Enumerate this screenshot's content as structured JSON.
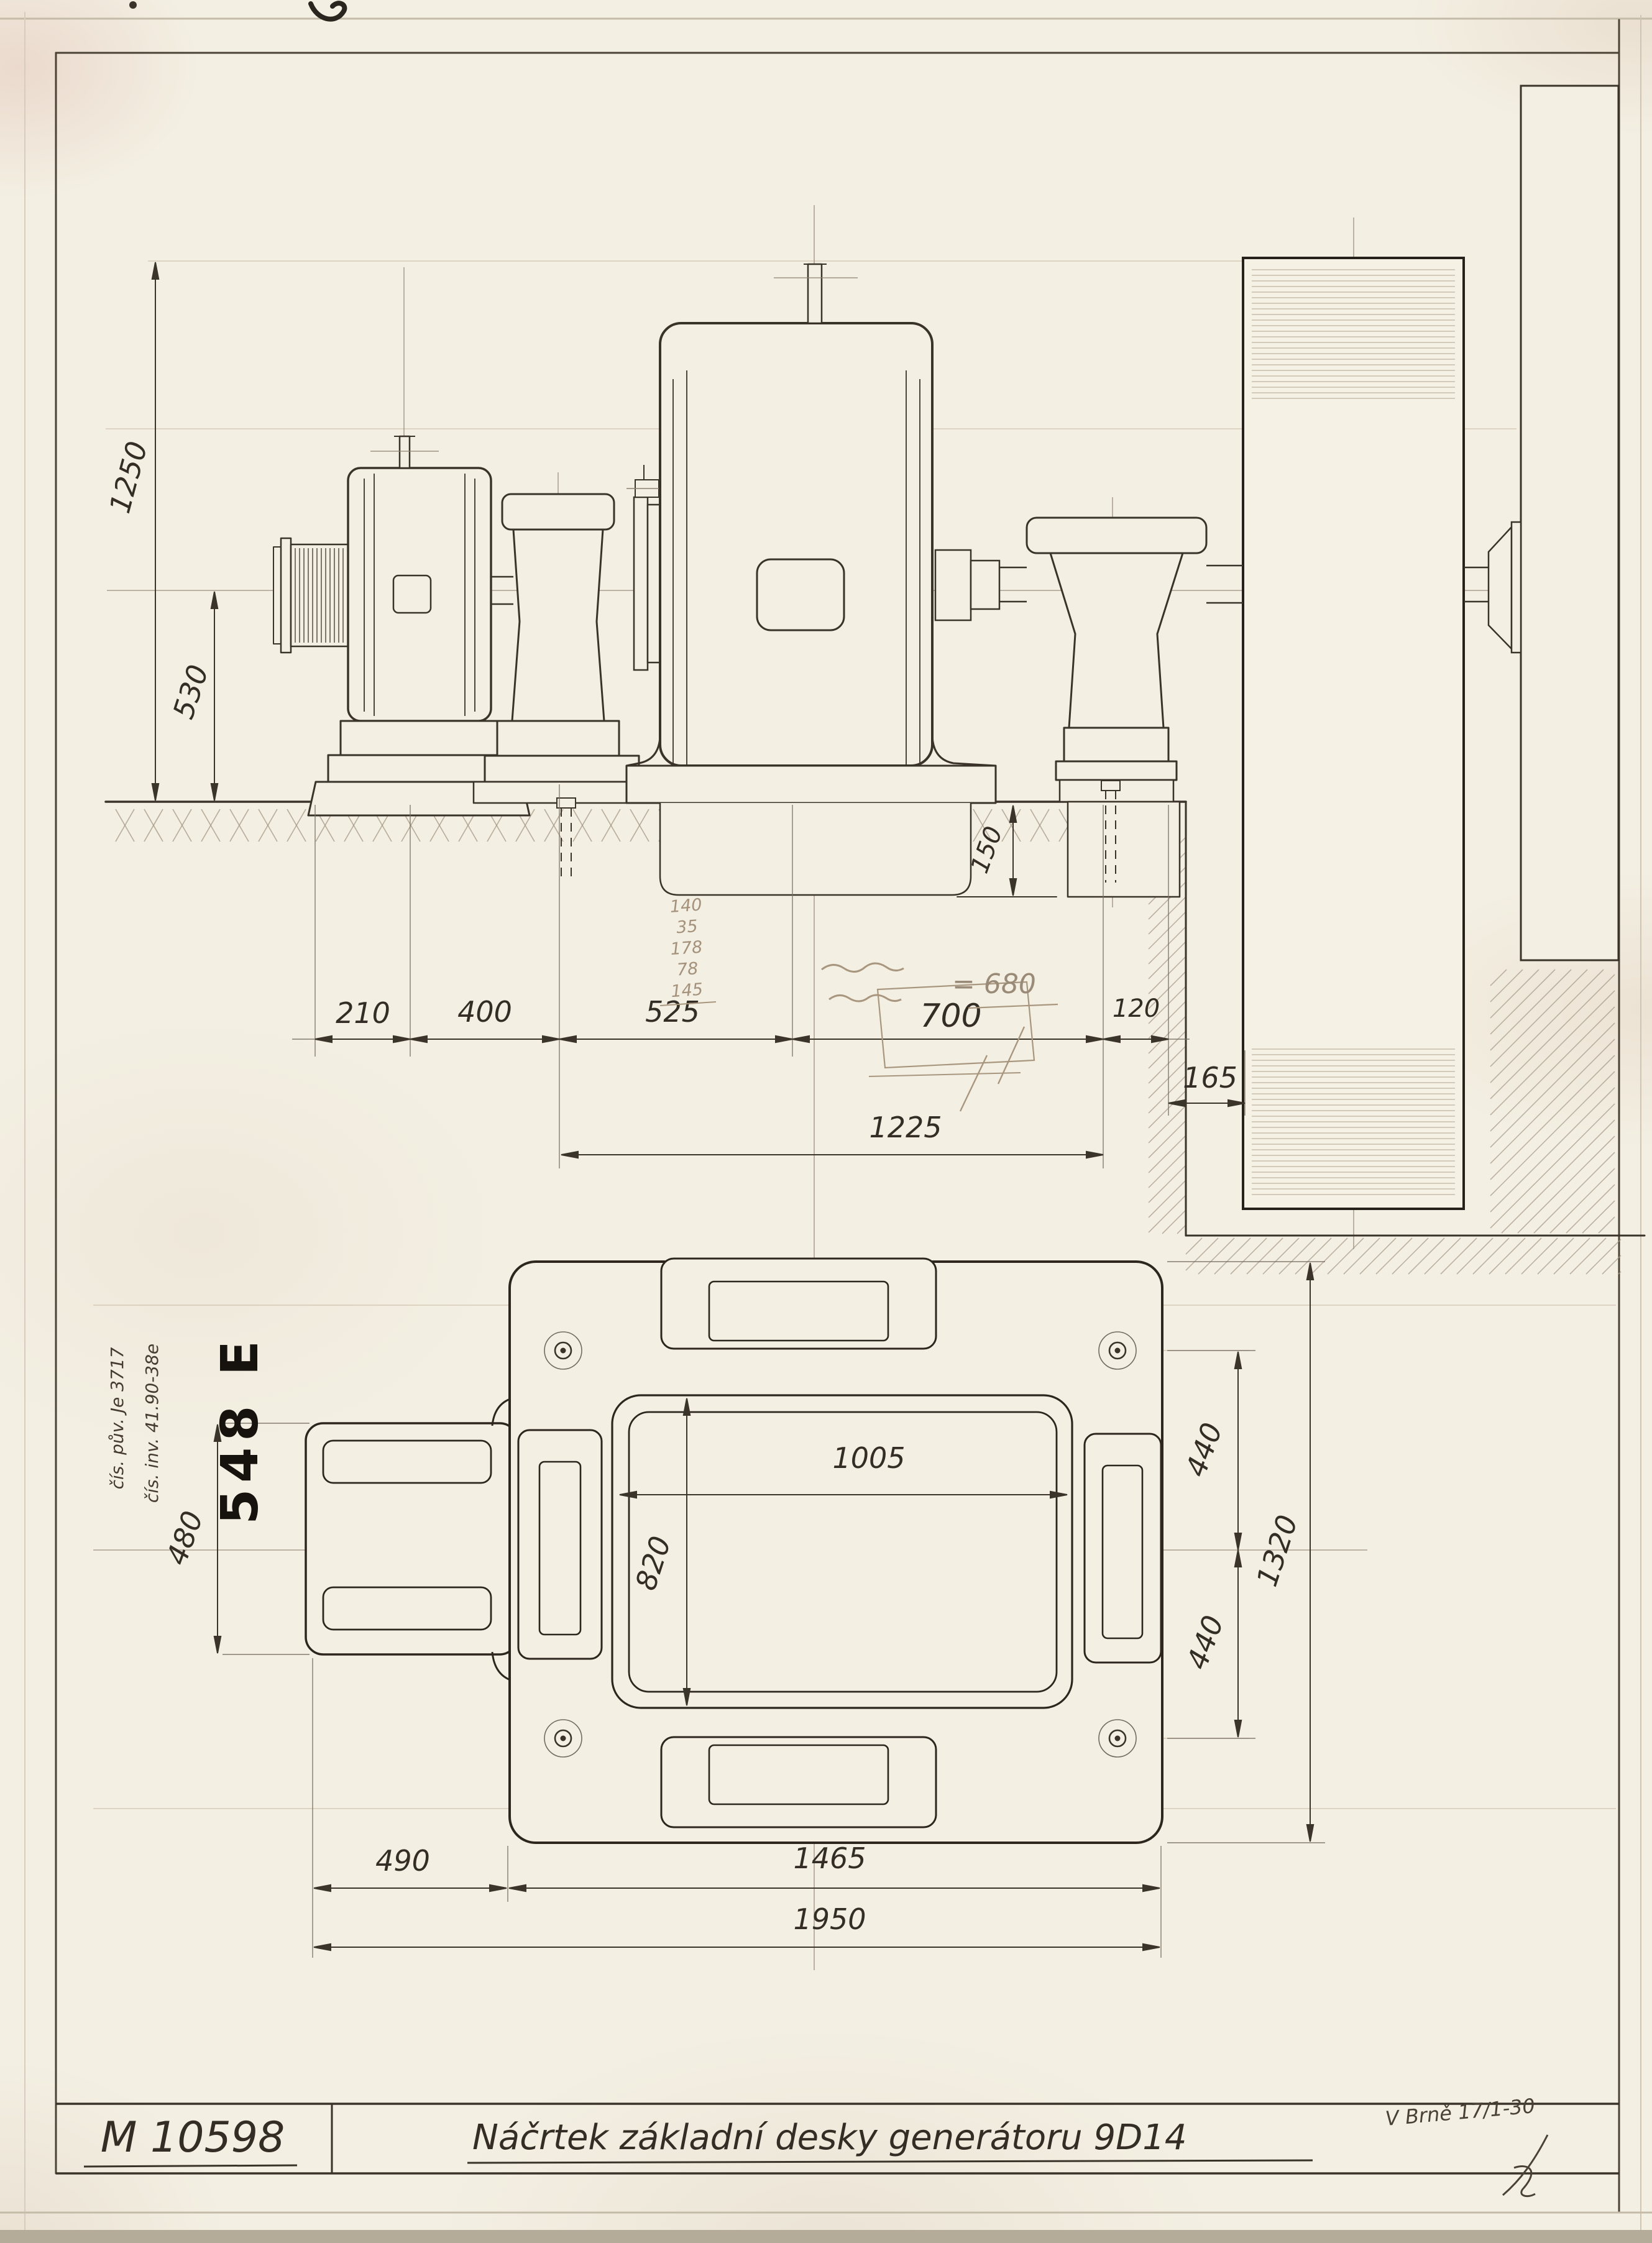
{
  "sheet": {
    "bg": "#f3efe2",
    "ink": "#3a332a",
    "pencil": "#998b77",
    "faint": "#c9b6a2"
  },
  "title_block": {
    "drawing_number": "M 10598",
    "title": "Náčrtek základní desky generátoru 9D14",
    "place_date": "V Brně 17/1-30"
  },
  "stamp": {
    "text": "548 E"
  },
  "side_notes": {
    "line1": "čís. pův. Je 3717",
    "line2": "čís. inv. 41.90-38e"
  },
  "pencil_notes": {
    "equals_note": "= 680",
    "calc": [
      "140",
      "35",
      "178",
      "78",
      "145"
    ]
  },
  "elevation_dims": {
    "v1250": "1250",
    "v530": "530",
    "v150": "150",
    "h210": "210",
    "h400": "400",
    "h525": "525",
    "h700": "700",
    "h120": "120",
    "h165": "165",
    "h1225": "1225"
  },
  "plan_dims": {
    "h1005": "1005",
    "v820": "820",
    "v480": "480",
    "v440_top": "440",
    "v440_bottom": "440",
    "v1320": "1320",
    "h490": "490",
    "h1465": "1465",
    "h1950": "1950"
  }
}
